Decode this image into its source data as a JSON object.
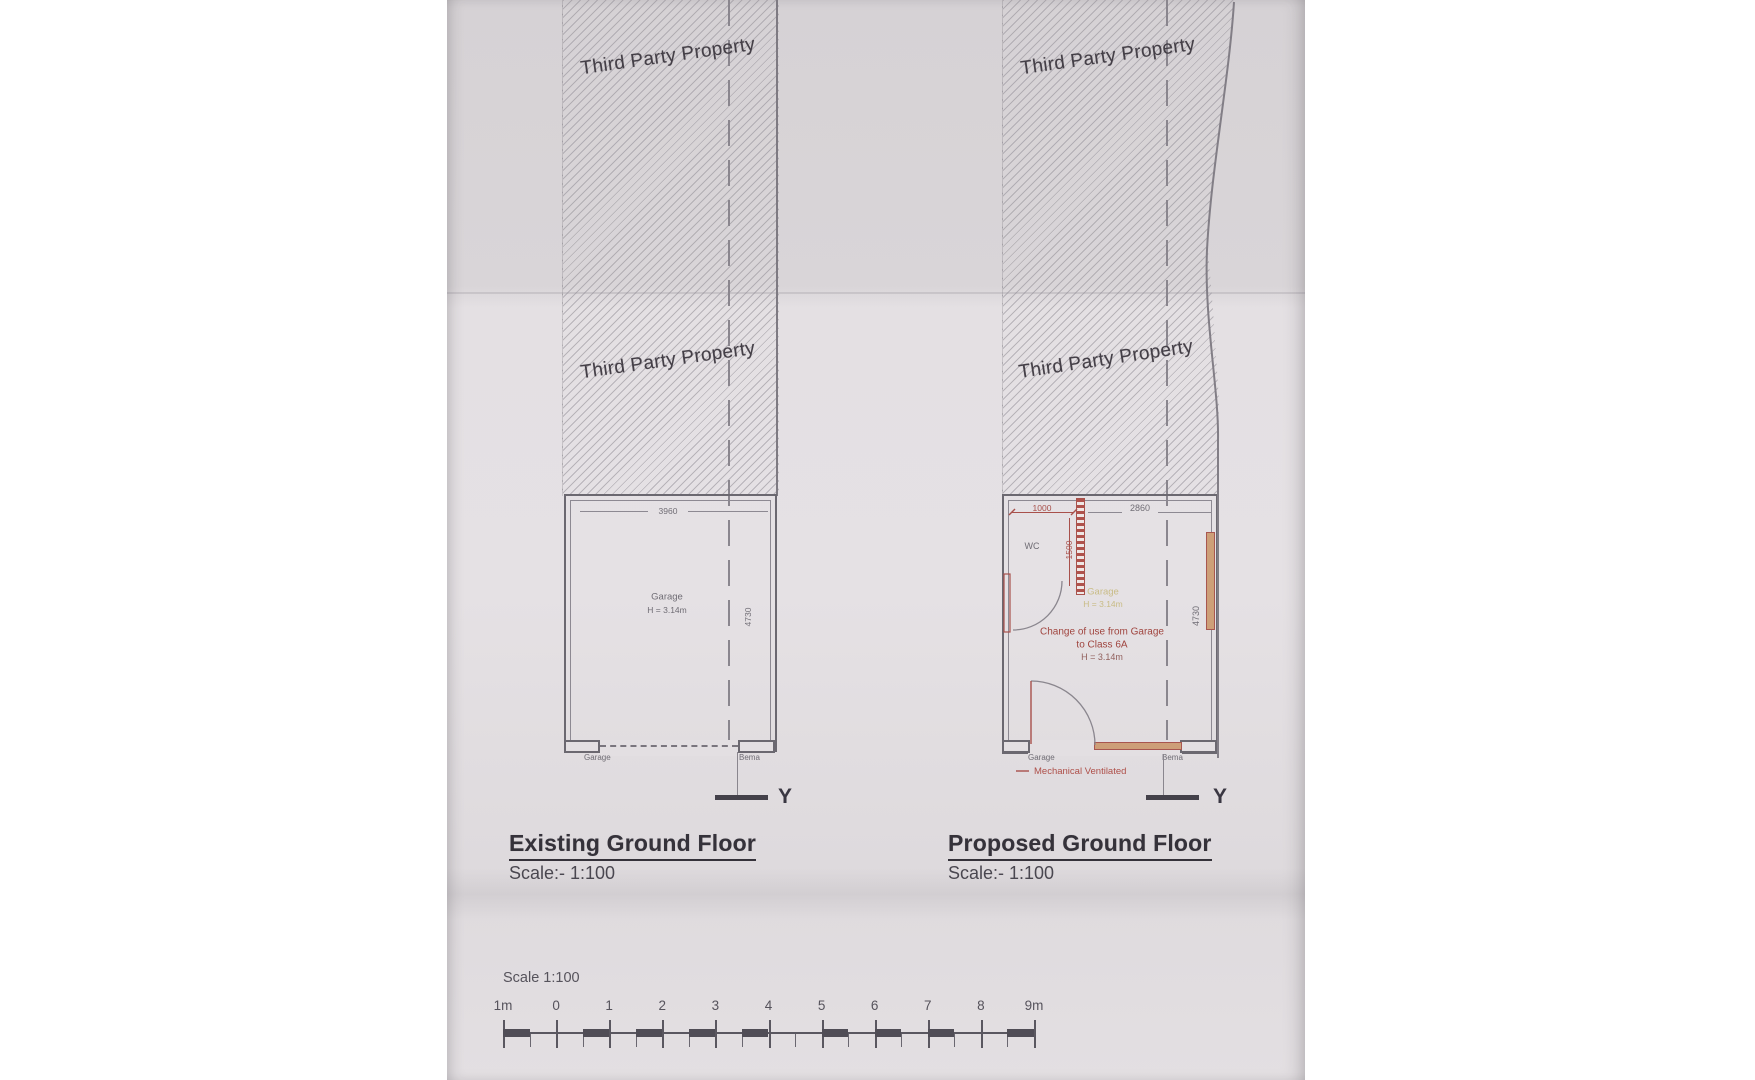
{
  "boundary": {
    "label": "Third Party Property"
  },
  "existing": {
    "title": "Existing Ground Floor",
    "scale_label": "Scale:- 1:100",
    "section_letter": "Y",
    "plan": {
      "width_dim": "3960",
      "depth_dim": "4730",
      "room_name": "Garage",
      "room_height": "H = 3.14m",
      "door_label": "Garage",
      "side_label": "Bema"
    }
  },
  "proposed": {
    "title": "Proposed Ground Floor",
    "scale_label": "Scale:- 1:100",
    "section_letter": "Y",
    "plan": {
      "wc_width_dim": "1000",
      "wc_depth_dim": "1500",
      "width_dim": "2860",
      "depth_dim": "4730",
      "wc_label": "WC",
      "old_room_name": "Garage",
      "old_room_height": "H = 3.14m",
      "note_line1": "Change of use from Garage",
      "note_line2": "to Class 6A",
      "note_line3": "H = 3.14m",
      "door_label": "Garage",
      "side_label": "Bema",
      "vent_note": "Mechanical Ventilated"
    }
  },
  "scalebar": {
    "label": "Scale 1:100",
    "ticks": [
      "1m",
      "0",
      "1",
      "2",
      "3",
      "4",
      "5",
      "6",
      "7",
      "8",
      "9m"
    ],
    "dark_pattern": [
      1,
      0,
      0,
      1,
      0,
      1,
      0,
      1,
      0,
      1,
      0,
      0,
      1,
      0,
      1,
      0,
      1,
      0,
      0,
      1
    ]
  },
  "colors": {
    "red": "#a8504b",
    "tan": "#cd9f78",
    "yellow": "#c9bc86",
    "wall": "#6b6870",
    "ink": "#35323a"
  }
}
